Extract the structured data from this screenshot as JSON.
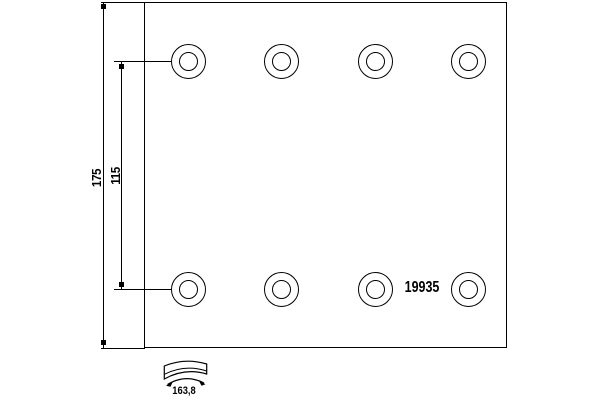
{
  "drawing": {
    "part_number": "19935",
    "dim_total_height": "175",
    "dim_hole_row_spacing": "115",
    "dim_arc_width": "163,8",
    "holes": {
      "rows": 2,
      "columns": 4,
      "total": 8
    }
  },
  "colors": {
    "line": "#000000",
    "background": "#ffffff"
  }
}
